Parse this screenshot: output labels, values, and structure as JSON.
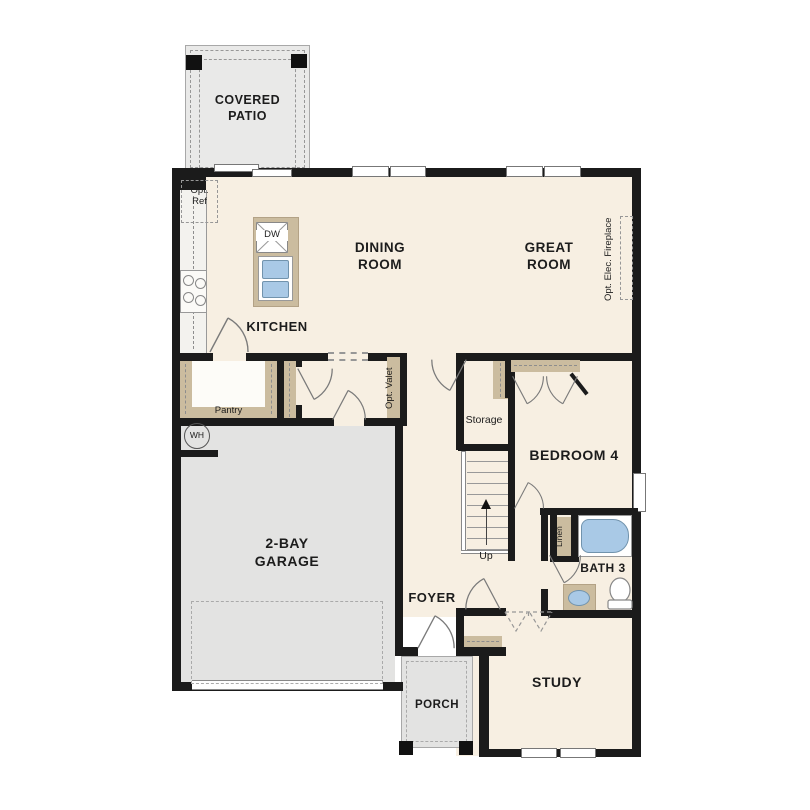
{
  "colors": {
    "floor_cream": "#f7efe2",
    "garage_gray": "#e3e3e2",
    "cabinet_tan": "#cbbc9f",
    "fixture_blue": "#a9c9e6",
    "wall_black": "#1b1b1b"
  },
  "rooms": {
    "covered_patio": {
      "label": "COVERED\nPATIO"
    },
    "kitchen": {
      "label": "KITCHEN"
    },
    "dining_room": {
      "label": "DINING\nROOM"
    },
    "great_room": {
      "label": "GREAT\nROOM"
    },
    "pantry": {
      "label": "Pantry"
    },
    "garage": {
      "label": "2-BAY\nGARAGE"
    },
    "storage": {
      "label": "Storage"
    },
    "bedroom4": {
      "label": "BEDROOM 4"
    },
    "bath3": {
      "label": "BATH 3"
    },
    "foyer": {
      "label": "FOYER"
    },
    "study": {
      "label": "STUDY"
    },
    "porch": {
      "label": "PORCH"
    }
  },
  "annotations": {
    "opt_ref": "Opt.\nRef",
    "dishwasher": "DW",
    "opt_elec_fireplace": "Opt. Elec. Fireplace",
    "opt_valet": "Opt. Valet",
    "water_heater": "WH",
    "linen": "Linen",
    "stairs_up": "Up"
  }
}
